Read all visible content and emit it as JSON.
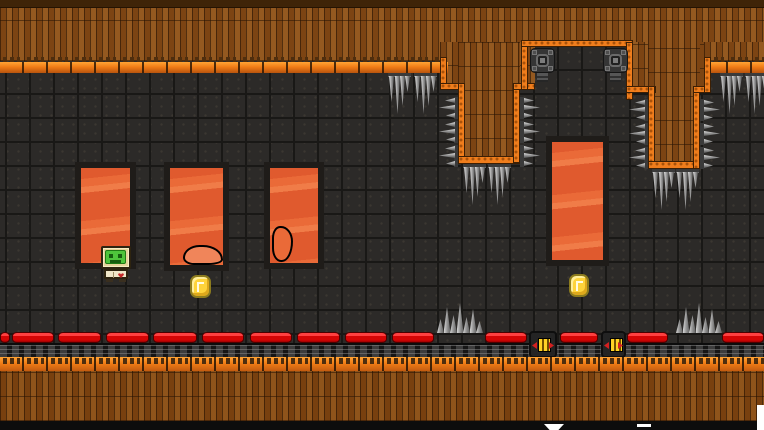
{
  "scene": {
    "width": 764,
    "height": 430,
    "type": "2d-platformer-level",
    "theme": "lava-cave"
  },
  "palette": {
    "background_tile": "#2c2a28",
    "tile_line": "#191816",
    "plank_brown": "#7c4413",
    "plank_light": "#94591c",
    "top_strip": "#3f2408",
    "ledge_orange_bright": "#ffa435",
    "ledge_orange_dark": "#b9540e",
    "edge_orange": "#ef7d1c",
    "edge_dot": "#a8520a",
    "lava_orange": "#e8632e",
    "lava_light": "#f07c48",
    "pillar_border": "#1f1c19",
    "rail_red": "#d50505",
    "rail_highlight": "#ff4040",
    "spike_gray": "#9a9a9a",
    "turret_gray": "#353535",
    "coin_yellow": "#fed33a",
    "coin_outline": "#8d7c1e",
    "player_frame_tan": "#e5d49b",
    "player_screen_green": "#4ec43b",
    "player_body_cream": "#efe6c8",
    "player_heart_red": "#c62828"
  },
  "ceiling": {
    "base": [
      0,
      0,
      764,
      45
    ],
    "top_strip": [
      0,
      0,
      764,
      8
    ],
    "plank_segments": [
      [
        0,
        42,
        446,
        19
      ],
      [
        440,
        42,
        95,
        48
      ],
      [
        458,
        42,
        62,
        121
      ],
      [
        626,
        42,
        84,
        51
      ],
      [
        648,
        42,
        52,
        127
      ],
      [
        704,
        42,
        60,
        19
      ]
    ],
    "ledge_rows": [
      [
        0,
        57,
        448,
        16
      ],
      [
        704,
        57,
        60,
        16
      ]
    ],
    "orange_edges": [
      [
        440,
        57,
        7,
        33
      ],
      [
        440,
        83,
        25,
        7
      ],
      [
        458,
        83,
        7,
        80
      ],
      [
        458,
        156,
        62,
        8
      ],
      [
        513,
        83,
        7,
        80
      ],
      [
        513,
        83,
        22,
        7
      ],
      [
        521,
        42,
        7,
        48
      ],
      [
        521,
        40,
        112,
        7
      ],
      [
        626,
        42,
        7,
        58
      ],
      [
        626,
        86,
        30,
        7
      ],
      [
        648,
        86,
        7,
        83
      ],
      [
        648,
        161,
        52,
        8
      ],
      [
        693,
        86,
        7,
        83
      ],
      [
        693,
        86,
        17,
        7
      ],
      [
        704,
        57,
        7,
        36
      ]
    ]
  },
  "lava_pillars": [
    [
      81,
      168,
      49,
      95
    ],
    [
      170,
      168,
      53,
      97
    ],
    [
      270,
      168,
      48,
      95
    ],
    [
      552,
      142,
      51,
      118
    ]
  ],
  "lava_blobs": [
    {
      "rect": [
        183,
        245,
        40,
        20
      ],
      "style": "filled"
    },
    {
      "rect": [
        272,
        226,
        21,
        36
      ],
      "style": "outline"
    }
  ],
  "coins": [
    [
      190,
      275,
      21,
      23
    ],
    [
      569,
      274,
      20,
      23
    ]
  ],
  "player": {
    "rect": [
      100,
      246,
      34,
      36
    ]
  },
  "hazards": {
    "hanging_spikes": [
      [
        388,
        73
      ],
      [
        414,
        73
      ],
      [
        463,
        164
      ],
      [
        488,
        164
      ],
      [
        652,
        169
      ],
      [
        676,
        169
      ],
      [
        720,
        73
      ],
      [
        745,
        73
      ]
    ],
    "wall_spikes_left": [
      [
        437,
        97
      ],
      [
        437,
        121
      ],
      [
        437,
        145
      ],
      [
        627,
        99
      ],
      [
        627,
        123
      ],
      [
        627,
        147
      ]
    ],
    "wall_spikes_right": [
      [
        520,
        97
      ],
      [
        520,
        121
      ],
      [
        520,
        145
      ],
      [
        700,
        99
      ],
      [
        700,
        123
      ],
      [
        700,
        147
      ]
    ],
    "floor_spike_clusters": [
      [
        437,
        303
      ],
      [
        676,
        303
      ]
    ],
    "turrets": [
      [
        530,
        48
      ],
      [
        603,
        48
      ]
    ]
  },
  "floor": {
    "rail_y": 332,
    "rail_segments": [
      [
        0,
        10
      ],
      [
        12,
        42
      ],
      [
        58,
        43
      ],
      [
        106,
        43
      ],
      [
        153,
        44
      ],
      [
        202,
        42
      ],
      [
        250,
        42
      ],
      [
        297,
        43
      ],
      [
        345,
        42
      ],
      [
        392,
        42
      ],
      [
        485,
        42
      ],
      [
        560,
        38
      ],
      [
        627,
        41
      ],
      [
        722,
        42
      ]
    ],
    "stripe_boxes": [
      [
        529,
        331,
        28,
        27
      ],
      [
        601,
        331,
        25,
        27
      ]
    ],
    "legs_strip": [
      0,
      343,
      764,
      15
    ],
    "ledge_row": [
      0,
      357,
      764,
      16
    ],
    "plank_strip": [
      0,
      371,
      764,
      50
    ],
    "bottom_strip": [
      0,
      421,
      764,
      9
    ]
  },
  "edge_fragments": [
    {
      "rect": [
        544,
        424,
        20,
        6
      ],
      "shape": "trapezoid"
    },
    {
      "rect": [
        637,
        424,
        14,
        3
      ],
      "shape": "bar"
    },
    {
      "rect": [
        757,
        405,
        7,
        25
      ],
      "shape": "bar"
    }
  ]
}
